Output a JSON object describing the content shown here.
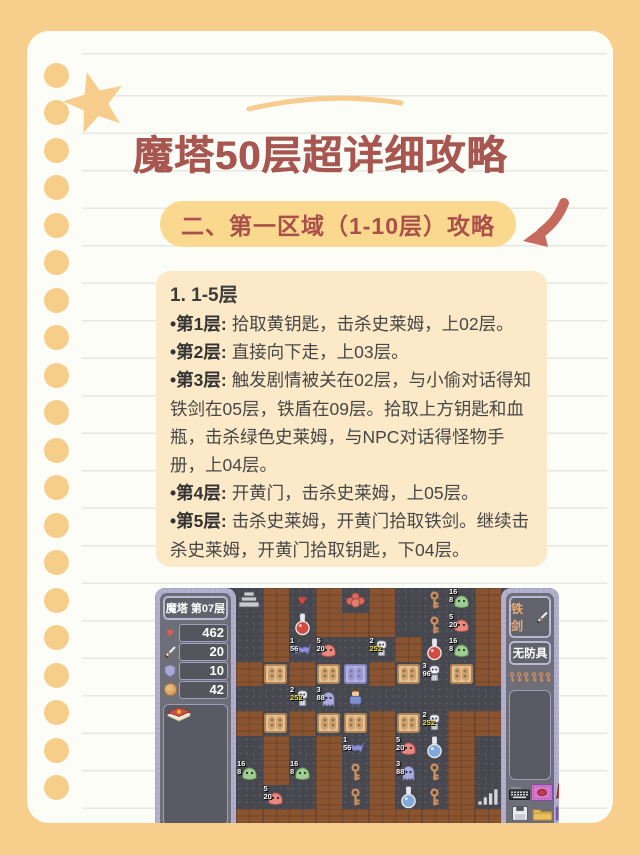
{
  "page": {
    "bg_color": "#f8ce8c",
    "title": "魔塔50层超详细攻略",
    "title_color": "#a75650"
  },
  "section": {
    "badge": "二、第一区域（1-10层）攻略",
    "badge_bg": "#fad88e",
    "badge_text_color": "#aa4f49",
    "arrow_color": "#c8695d"
  },
  "guide": {
    "heading": "1. 1-5层",
    "items": [
      {
        "label": "•第1层:",
        "text": "拾取黄钥匙，击杀史莱姆，上02层。"
      },
      {
        "label": "•第2层:",
        "text": "直接向下走，上03层。"
      },
      {
        "label": "•第3层:",
        "text": "触发剧情被关在02层，与小偷对话得知铁剑在05层，铁盾在09层。拾取上方钥匙和血瓶，击杀绿色史莱姆，与NPC对话得怪物手册，上04层。"
      },
      {
        "label": "•第4层:",
        "text": "开黄门，击杀史莱姆，上05层。"
      },
      {
        "label": "•第5层:",
        "text": "击杀史莱姆，开黄门拾取铁剑。继续击杀史莱姆，开黄门拾取钥匙，下04层。"
      }
    ]
  },
  "game": {
    "floor_label": "魔塔 第07层",
    "stats": [
      {
        "icon": "heart-icon",
        "value": "462"
      },
      {
        "icon": "sword-icon",
        "value": "20"
      },
      {
        "icon": "shield-icon",
        "value": "10"
      },
      {
        "icon": "coin-icon",
        "value": "42"
      }
    ],
    "equipment": {
      "weapon": "铁剑",
      "armor": "无防具",
      "yellow_keys": 6
    },
    "panel_icons": [
      "keyboard-icon",
      "shop-icon",
      "boots-icon",
      "floppy-icon",
      "folder-icon",
      "pens-icon"
    ],
    "map": {
      "legend": "W=wall F=floor S=stairs-up ST2=stairs-bars DY=yellow-door DB=blue-door K=yellow-key PR=red-potion PB=blue-potion HT=heart FL=flower-monster GS=green-slime RS=red-slime BA=bat SK=skeleton GH=ghost HE=hero; numbers = on-map damage labels",
      "tiles": [
        [
          "S",
          "W",
          "HT",
          "W",
          "FL",
          "W",
          "F",
          "K",
          "GS 16 8",
          "W"
        ],
        [
          "F",
          "W",
          "PR",
          "W",
          "W",
          "W",
          "F",
          "K",
          "RS 5 20",
          "W"
        ],
        [
          "F",
          "W",
          "BA 1 56",
          "RS 5 20",
          "F",
          "SK 2 252y",
          "W",
          "PR",
          "GS 16 8",
          "W"
        ],
        [
          "W",
          "DY",
          "W",
          "DY",
          "DB",
          "W",
          "DY",
          "SK 3 96",
          "DY",
          "W"
        ],
        [
          "F",
          "F",
          "SK 2 252y",
          "GH 3 88",
          "HE",
          "F",
          "F",
          "F",
          "F",
          "F"
        ],
        [
          "W",
          "DY",
          "W",
          "DY",
          "DY",
          "W",
          "DY",
          "SK 2 252y",
          "W",
          "W"
        ],
        [
          "F",
          "W",
          "F",
          "W",
          "BA 1 56",
          "W",
          "RS 5 20",
          "PB",
          "W",
          "F"
        ],
        [
          "GS 16 8",
          "W",
          "GS 16 8",
          "W",
          "K",
          "W",
          "GH 3 88",
          "K",
          "W",
          "F"
        ],
        [
          "F",
          "RS 5 20",
          "F",
          "W",
          "K",
          "W",
          "PB",
          "K",
          "W",
          "ST2"
        ],
        [
          "W",
          "W",
          "W",
          "W",
          "W",
          "W",
          "W",
          "W",
          "W",
          "W"
        ]
      ]
    }
  }
}
